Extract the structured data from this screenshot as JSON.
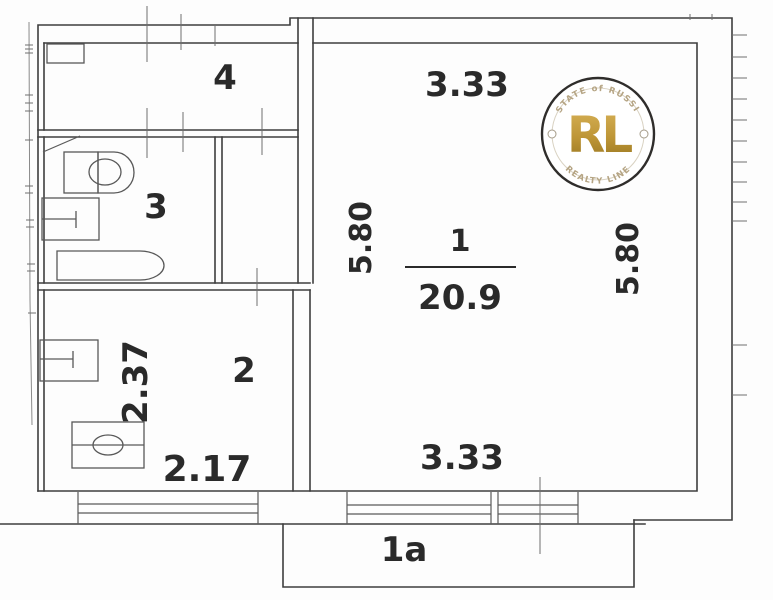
{
  "title": "apartment-floor-plan",
  "rooms": {
    "main": {
      "number": "1",
      "area": "20.9"
    },
    "kitchen": {
      "number": "2"
    },
    "bathroom": {
      "number": "3"
    },
    "hall": {
      "number": "4"
    },
    "balcony": {
      "number": "1a"
    }
  },
  "dimensions": {
    "main_width_top": "3.33",
    "main_width_bottom": "3.33",
    "main_height_left": "5.80",
    "main_height_right": "5.80",
    "kitchen_height": "2.37",
    "kitchen_width": "2.17"
  },
  "logo": {
    "monogram": "RL",
    "arc_top": "ESTATE of RUSSIA",
    "arc_bottom": "REALTY LINE"
  },
  "colors": {
    "wall_line": "#3e3e3e",
    "text": "#2a2a2a",
    "logo_gold": "#b58c2e",
    "logo_gold_light": "#d4ad4e",
    "logo_ring": "#2f2d2b",
    "logo_arc_text": "#b5a483"
  }
}
